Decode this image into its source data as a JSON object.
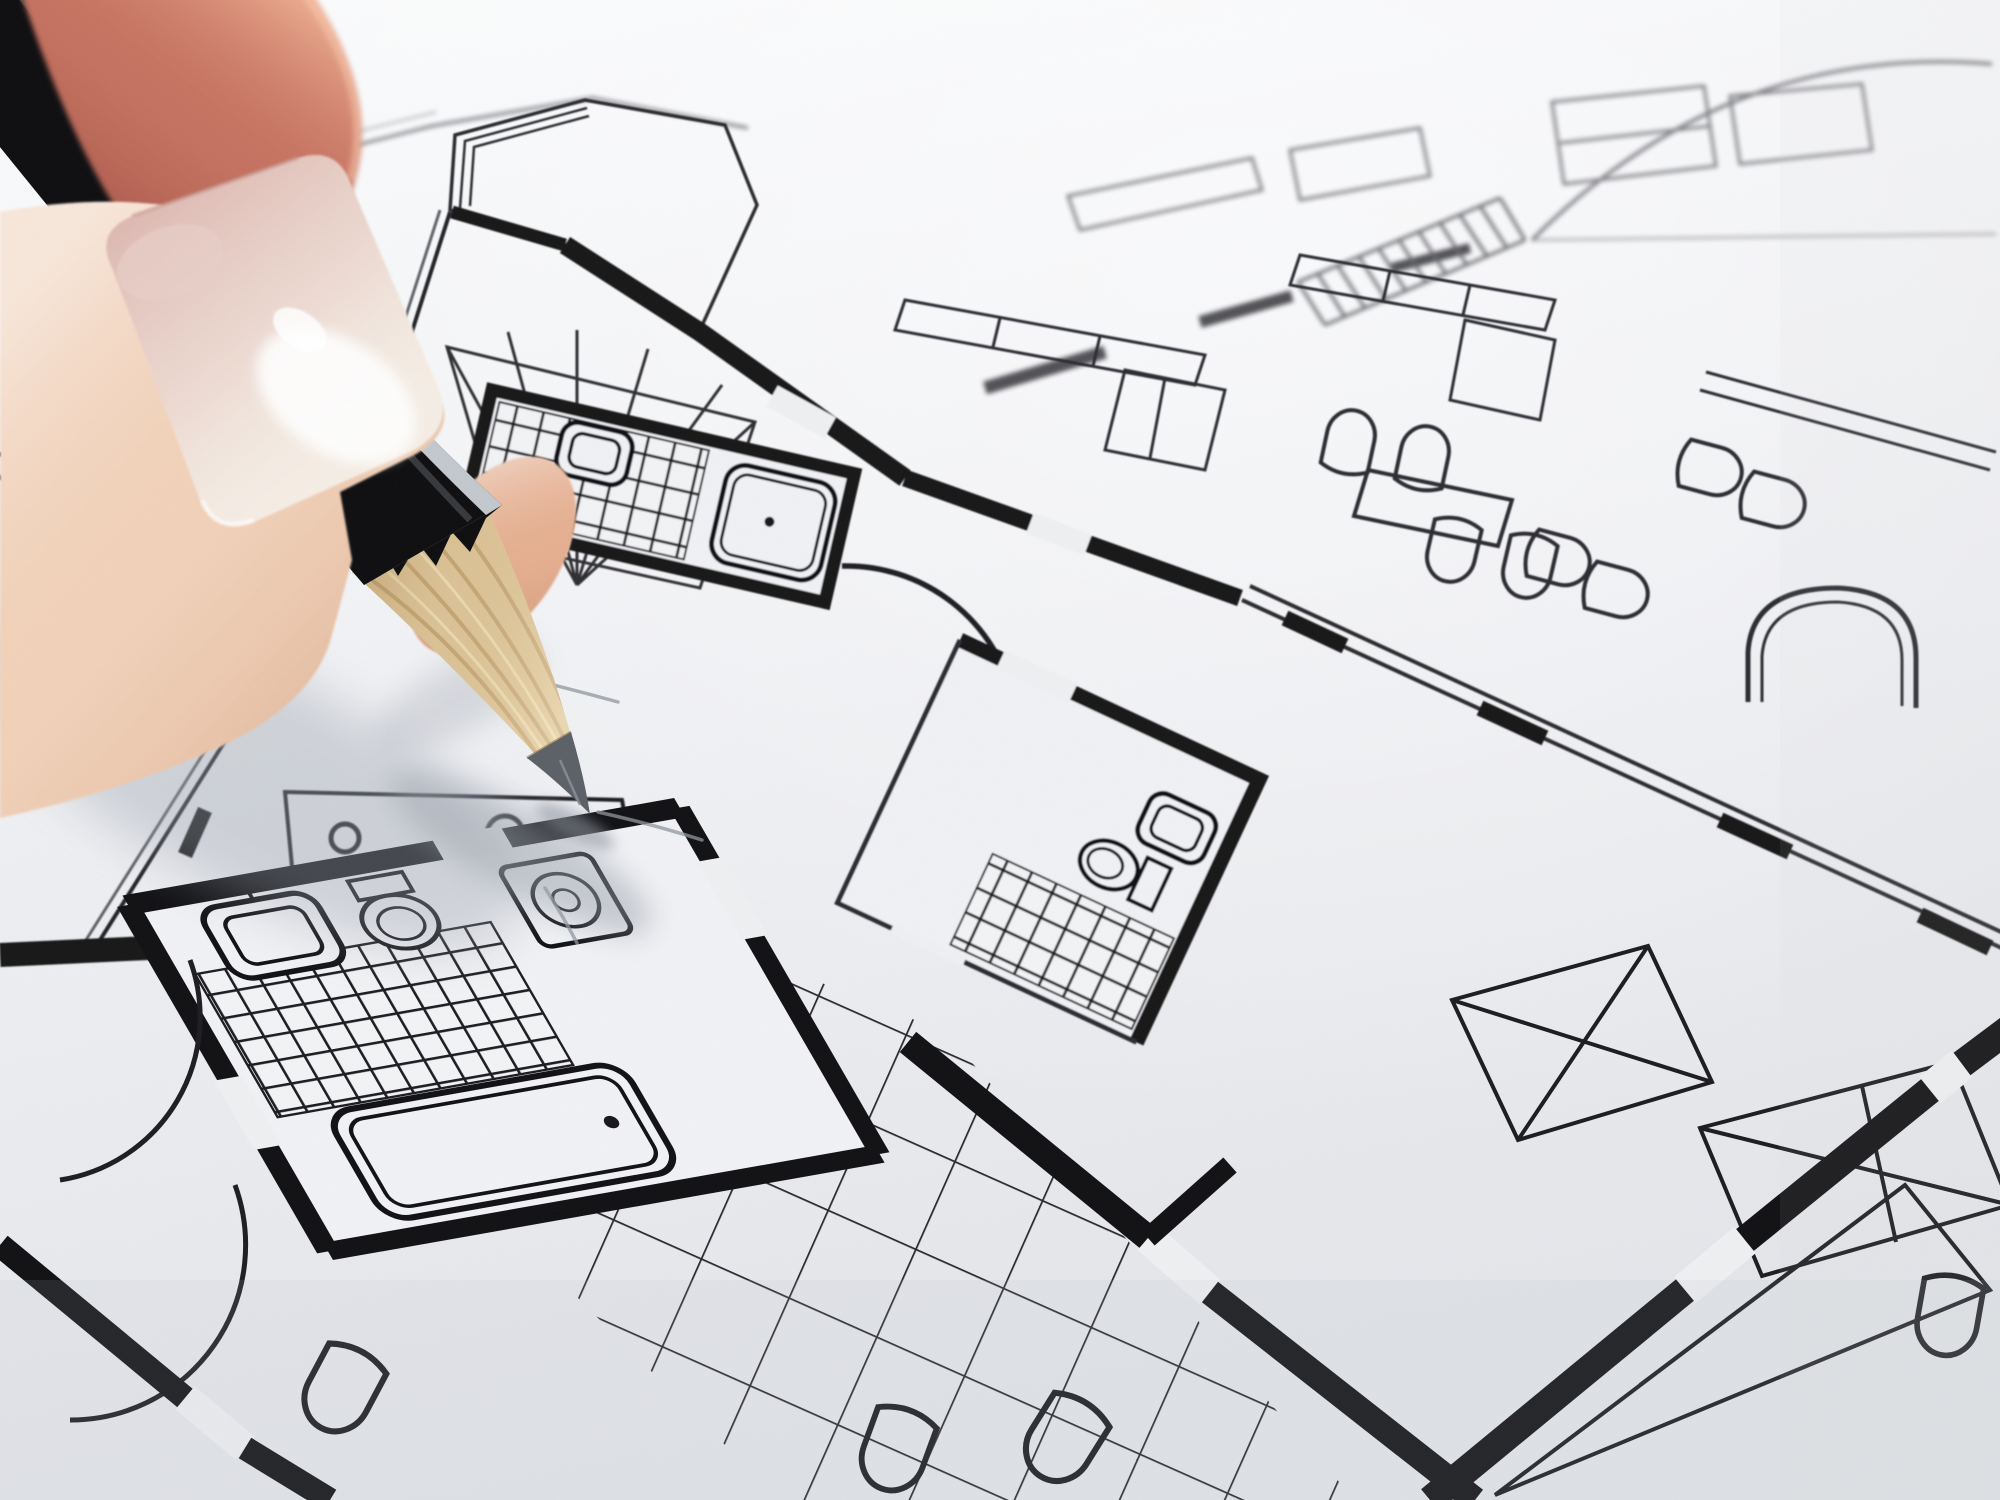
{
  "image": {
    "type": "macro photograph",
    "description": "A hand holding a black pencil with a freshly sharpened tip poised on a black-and-white architectural floor plan; the plan recedes diagonally with shallow depth of field blurring the far edge",
    "focus_point": "graphite tip touching the paper",
    "no_visible_text": true
  },
  "hand": {
    "parts": "shadowed finger above, finger with large glossy nail in front, fingertip pad beside the pencil tip",
    "nail_finish": "glossy with bright specular highlight"
  },
  "pencil": {
    "body": "black lacquered barrel",
    "edge_highlight": "silver reflective edge",
    "tip": "sharpened wood cone with dark graphite point",
    "state": "touching paper; faint fresh gray strokes nearby"
  },
  "paper": {
    "color": "white drawing paper",
    "depth_of_field": "far region out of focus"
  },
  "floor_plan": {
    "style": "black ink line drawing, thick walls filled solid",
    "features": [
      "octagonal bay corner with radiating wardrobe lines",
      "upper bathroom with fine square-tiled floor, washbasin and bathtub",
      "central bathroom with washbasin, toilet and tiled floor",
      "foreground bathroom with washbasin, toilet, washing machine, tiled floor and bathtub",
      "kitchen hob with four burner circles",
      "large-tiled hallway floor under the pencil tip",
      "quarter-circle door swing arcs",
      "thick black walls with white door and window openings",
      "X-crossed wardrobe rectangles",
      "staircase with tread hatching",
      "tables with arch-shaped chairs",
      "L-shaped counters and sofas",
      "arched doorway"
    ]
  },
  "palette": {
    "paper": "#eef0f2",
    "paper_bright": "#fbfcfd",
    "paper_shade": "#e3e5ea",
    "ink_near": "#17171a",
    "ink_mid": "#2a2a2e",
    "ink_far": "#6f7076",
    "pencil_black": "#0d0d0f",
    "silver": "#cfd4d9",
    "wood_mid": "#dcc498",
    "wood_dark": "#b3925f",
    "graphite": "#5b6066",
    "skin_light": "#f2d4bc",
    "skin_mid": "#e5ae90",
    "skin_deep": "#c4705f",
    "nail_tip": "#f5eee5",
    "nail_bed": "#d9b3ad",
    "shadow": "#9aa0ac"
  }
}
